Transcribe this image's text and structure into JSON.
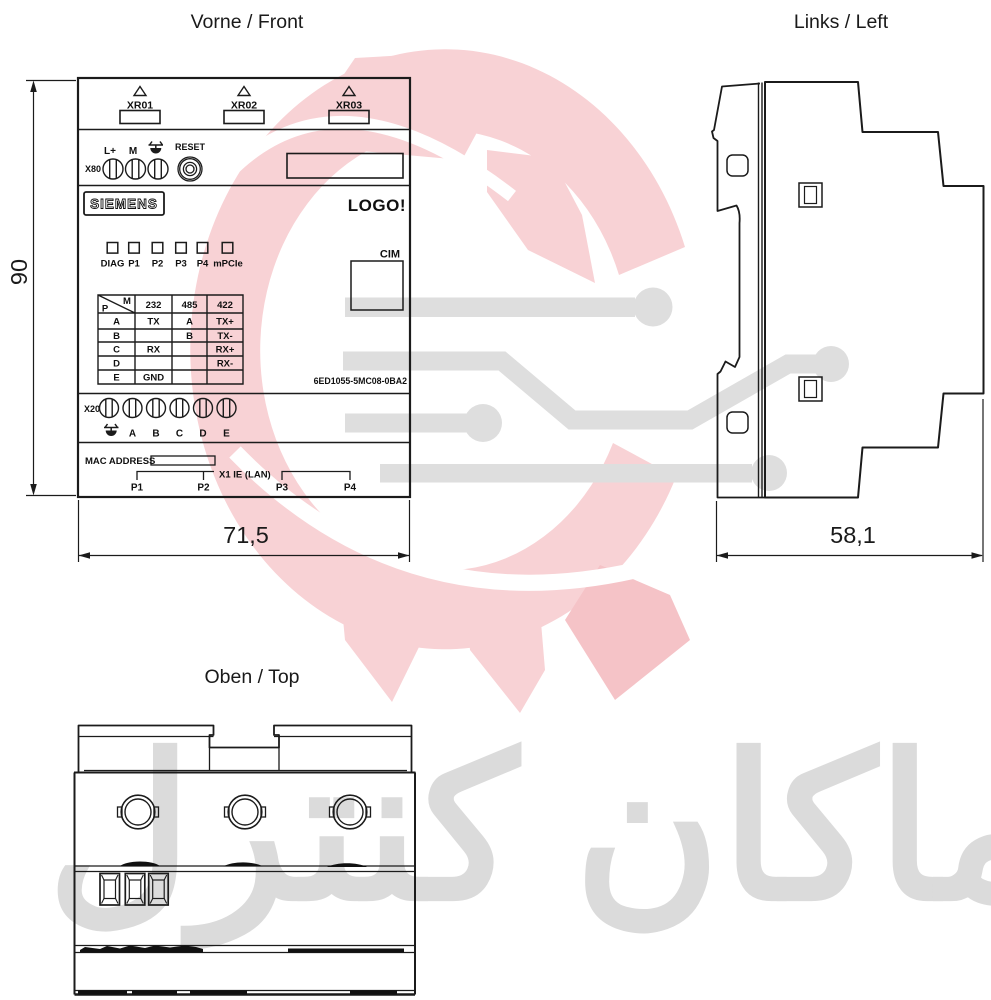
{
  "titles": {
    "front": "Vorne / Front",
    "left": "Links / Left",
    "top": "Oben / Top"
  },
  "front": {
    "xr_ports": [
      "XR01",
      "XR02",
      "XR03"
    ],
    "power": {
      "terminal_block": "X80",
      "labels": [
        "L+",
        "M"
      ],
      "reset": "RESET"
    },
    "brand": "SIEMENS",
    "product": "LOGO!",
    "leds": [
      "DIAG",
      "P1",
      "P2",
      "P3",
      "P4",
      "mPCIe"
    ],
    "module": "CIM",
    "part_number": "6ED1055-5MC08-0BA2",
    "pin_table": {
      "corner": {
        "top": "M",
        "bottom": "P"
      },
      "columns": [
        "232",
        "485",
        "422"
      ],
      "rows": [
        {
          "pin": "A",
          "m232": "TX",
          "m485": "A",
          "m422": "TX+"
        },
        {
          "pin": "B",
          "m232": "",
          "m485": "B",
          "m422": "TX-"
        },
        {
          "pin": "C",
          "m232": "RX",
          "m485": "",
          "m422": "RX+"
        },
        {
          "pin": "D",
          "m232": "",
          "m485": "",
          "m422": "RX-"
        },
        {
          "pin": "E",
          "m232": "GND",
          "m485": "",
          "m422": ""
        }
      ]
    },
    "x20": {
      "terminal_block": "X20",
      "labels": [
        "A",
        "B",
        "C",
        "D",
        "E"
      ]
    },
    "bottom": {
      "mac": "MAC ADDRESS",
      "lan": "X1 IE (LAN)",
      "ports": [
        "P1",
        "P2",
        "P3",
        "P4"
      ]
    }
  },
  "dimensions": {
    "height_mm": "90",
    "width_mm": "71,5",
    "depth_mm": "58,1"
  },
  "watermark": {
    "text": "ماكان كنترل",
    "pink": "#f8d2d5",
    "gray": "#dedede"
  }
}
